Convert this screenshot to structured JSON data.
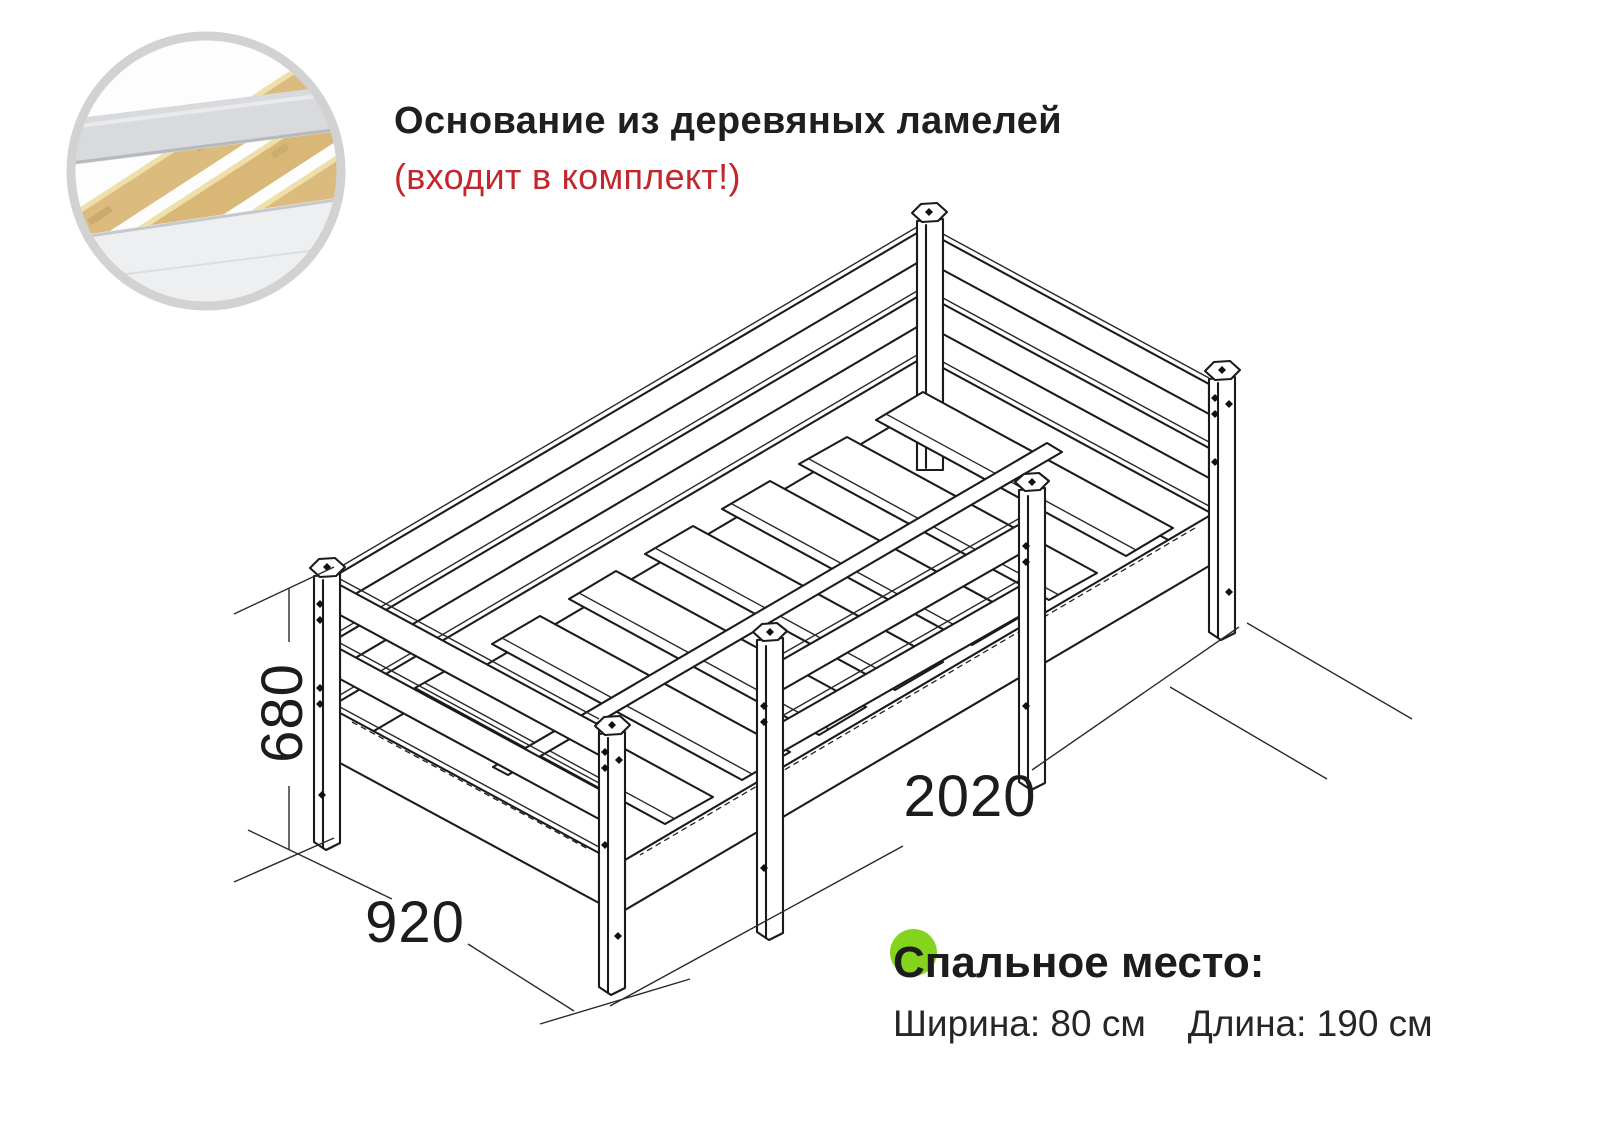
{
  "header": {
    "title": "Основание из деревяных ламелей",
    "subtitle": "(входит в комплект!)",
    "title_color": "#1f1f1f",
    "subtitle_color": "#c2272d"
  },
  "inset": {
    "description": "photo of wooden slat base on gray bed frame",
    "ring_color": "#d2d2d2",
    "slat_wood_color": "#dcbc7e",
    "frame_gray_color": "#d8dadd"
  },
  "drawing": {
    "description": "isometric line drawing of single bed with safety rail",
    "line_color": "#1b1b1b"
  },
  "dimensions": {
    "height_mm": "680",
    "width_mm": "920",
    "length_mm": "2020"
  },
  "sleeping_area": {
    "heading": "Спальное место:",
    "width_label": "Ширина: 80 см",
    "length_label": "Длина: 190 см",
    "accent_color": "#84d41e"
  }
}
